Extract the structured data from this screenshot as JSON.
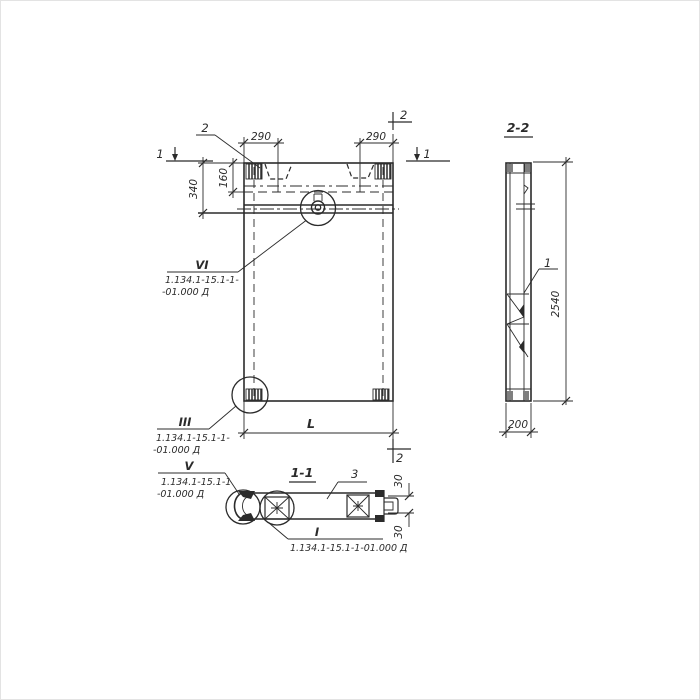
{
  "front_view": {
    "dim_290_left": "290",
    "dim_290_right": "290",
    "dim_340": "340",
    "dim_160": "160",
    "dim_length": "L",
    "section_mark_1_left": "1",
    "section_mark_1_right": "1",
    "section_mark_2_top": "2",
    "section_mark_2_bottom": "2",
    "key_leader_label": "2",
    "callout_vi": {
      "numeral": "VI",
      "ref_line1": "1.134.1-15.1-1-",
      "ref_line2": "-01.000 Д"
    },
    "callout_iii": {
      "numeral": "III",
      "ref_line1": "1.134.1-15.1-1-",
      "ref_line2": "-01.000 Д"
    }
  },
  "section_2_2": {
    "title": "2-2",
    "dim_height": "2540",
    "dim_width": "200",
    "part_label": "1"
  },
  "section_1_1": {
    "title": "1-1",
    "part_label": "3",
    "dim_30_top": "30",
    "dim_30_bottom": "30",
    "callout_v": {
      "numeral": "V",
      "ref_line1": "1.134.1-15.1-1",
      "ref_line2": "-01.000 Д"
    },
    "callout_i": {
      "numeral": "I",
      "ref_line1": "1.134.1-15.1-1-01.000 Д"
    }
  },
  "colors": {
    "ink": "#2b2b2b",
    "paper": "#ffffff"
  }
}
